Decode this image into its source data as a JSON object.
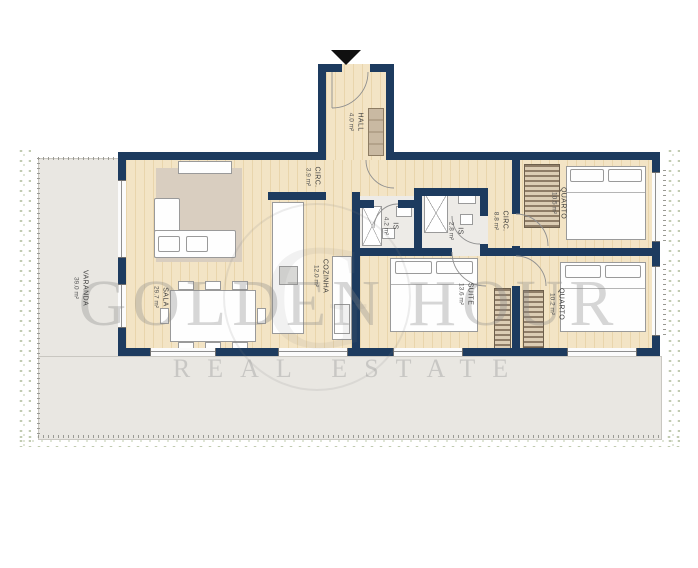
{
  "watermark": {
    "line1": "GOLDEN HOUR",
    "line2": "REAL ESTATE",
    "monogram": "G"
  },
  "rooms": {
    "hall": {
      "name": "HALL",
      "area": "4.0 m²"
    },
    "circ_top": {
      "name": "CIRC.",
      "area": "3.9 m²"
    },
    "cozinha": {
      "name": "COZINHA",
      "area": "12.0 m²"
    },
    "sala": {
      "name": "SALA",
      "area": "29.7 m²"
    },
    "is_main": {
      "name": "IS",
      "area": "4.2 m²"
    },
    "is_suite": {
      "name": "IS",
      "area": "2.8 m²"
    },
    "circ_bed": {
      "name": "CIRC.",
      "area": "8.8 m²"
    },
    "quarto_top": {
      "name": "QUARTO",
      "area": "10.5 m²"
    },
    "quarto_bottom": {
      "name": "QUARTO",
      "area": "10.2 m²"
    },
    "suite": {
      "name": "SUITE",
      "area": "13.6 m²"
    },
    "varanda": {
      "name": "VARANDA",
      "area": "39.0 m²"
    }
  },
  "colors": {
    "wall": "#1d3b5f",
    "wood_light": "#f3e4c5",
    "wood_dark": "#e9d5ac",
    "tile": "#edebe7",
    "terrace": "#e9e7e2",
    "hedge": "#b7c3a4",
    "rug": "#d9cec0",
    "wardrobe": "#8f7d67",
    "watermark_gray": "#8f8f8f"
  }
}
